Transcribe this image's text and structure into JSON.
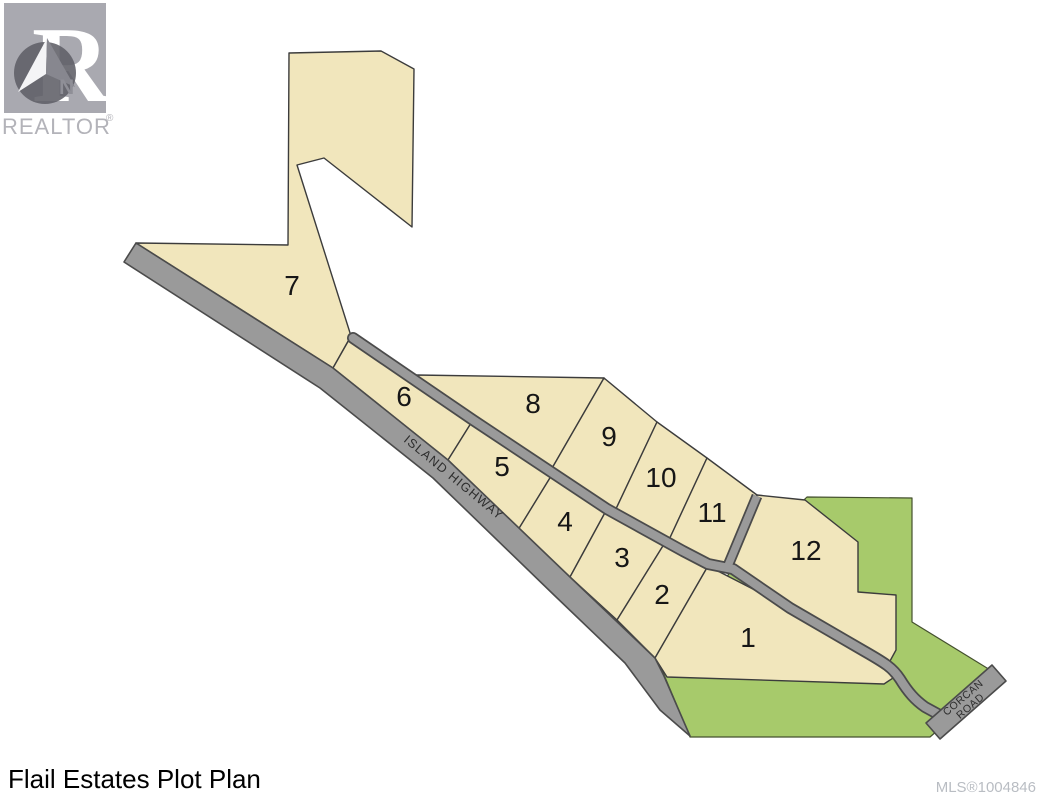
{
  "header_logo": {
    "realtor": "REALTOR",
    "registered": "®",
    "north": "N"
  },
  "footer": {
    "title": "Flail Estates Plot Plan",
    "mls": "MLS®1004846"
  },
  "roads": {
    "island_highway": "ISLAND HIGHWAY",
    "corcan_line1": "CORCAN",
    "corcan_line2": "ROAD"
  },
  "lots": [
    "1",
    "2",
    "3",
    "4",
    "5",
    "6",
    "7",
    "8",
    "9",
    "10",
    "11",
    "12"
  ],
  "colors": {
    "lot_fill": "#f1e6bc",
    "green_fill": "#a7ca6b",
    "road_fill": "#9a9a9a",
    "road_edge": "#4b4b4b"
  }
}
